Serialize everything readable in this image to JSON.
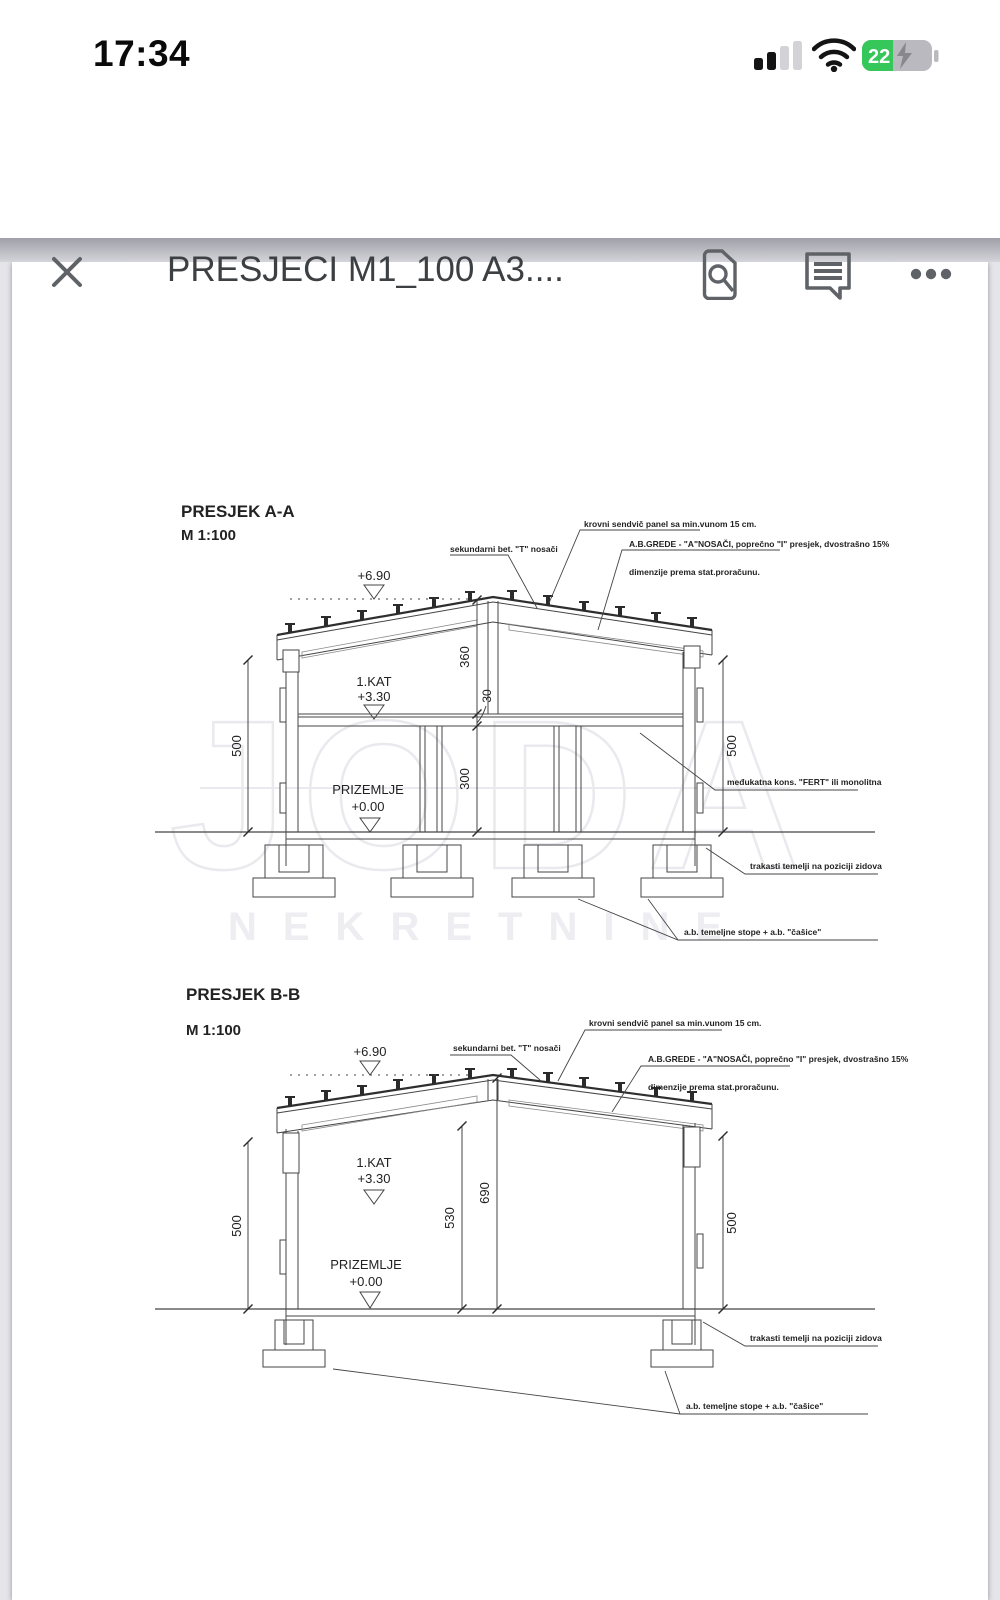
{
  "status_bar": {
    "time": "17:34",
    "battery_percent": "22"
  },
  "header": {
    "title": "PRESJECI M1_100 A3...."
  },
  "doc": {
    "watermark": {
      "name": "JODA",
      "subtitle": "NEKRETNINE"
    },
    "sections": [
      {
        "title": "PRESJEK A-A",
        "scale": "M 1:100",
        "levels": {
          "roof": "+6.90",
          "floor1_name": "1.KAT",
          "floor1": "+3.30",
          "ground_name": "PRIZEMLJE",
          "ground": "+0.00"
        },
        "dims": {
          "left": "500",
          "right": "500",
          "roof": "360",
          "slab": "30",
          "ground_floor": "300"
        },
        "notes": {
          "secondary_beams": "sekundarni bet. \"T\" nosači",
          "roof_panel": "krovni sendvič panel sa min.vunom 15 cm.",
          "ab_beams": "A.B.GREDE - \"A\"NOSAČI, poprečno \"I\" presjek, dvostrašno 15%",
          "ab_beams_2": "dimenzije prema stat.proračunu.",
          "floor_slab": "međukatna kons. \"FERT\" ili monolitna",
          "strip_foundations": "trakasti temelji na poziciji zidova",
          "footings": "a.b. temeljne stope + a.b. \"čašice\""
        }
      },
      {
        "title": "PRESJEK B-B",
        "scale": "M 1:100",
        "levels": {
          "roof": "+6.90",
          "floor1_name": "1.KAT",
          "floor1": "+3.30",
          "ground_name": "PRIZEMLJE",
          "ground": "+0.00"
        },
        "dims": {
          "left": "500",
          "right": "500",
          "wall": "530",
          "ridge": "690"
        },
        "notes": {
          "secondary_beams": "sekundarni bet. \"T\" nosači",
          "roof_panel": "krovni sendvič panel sa min.vunom 15 cm.",
          "ab_beams": "A.B.GREDE - \"A\"NOSAČI, poprečno \"I\" presjek, dvostrašno 15%",
          "ab_beams_2": "dimenzije prema stat.proračunu.",
          "strip_foundations": "trakasti temelji na poziciji zidova",
          "footings": "a.b. temeljne stope + a.b. \"čašice\""
        }
      }
    ]
  }
}
